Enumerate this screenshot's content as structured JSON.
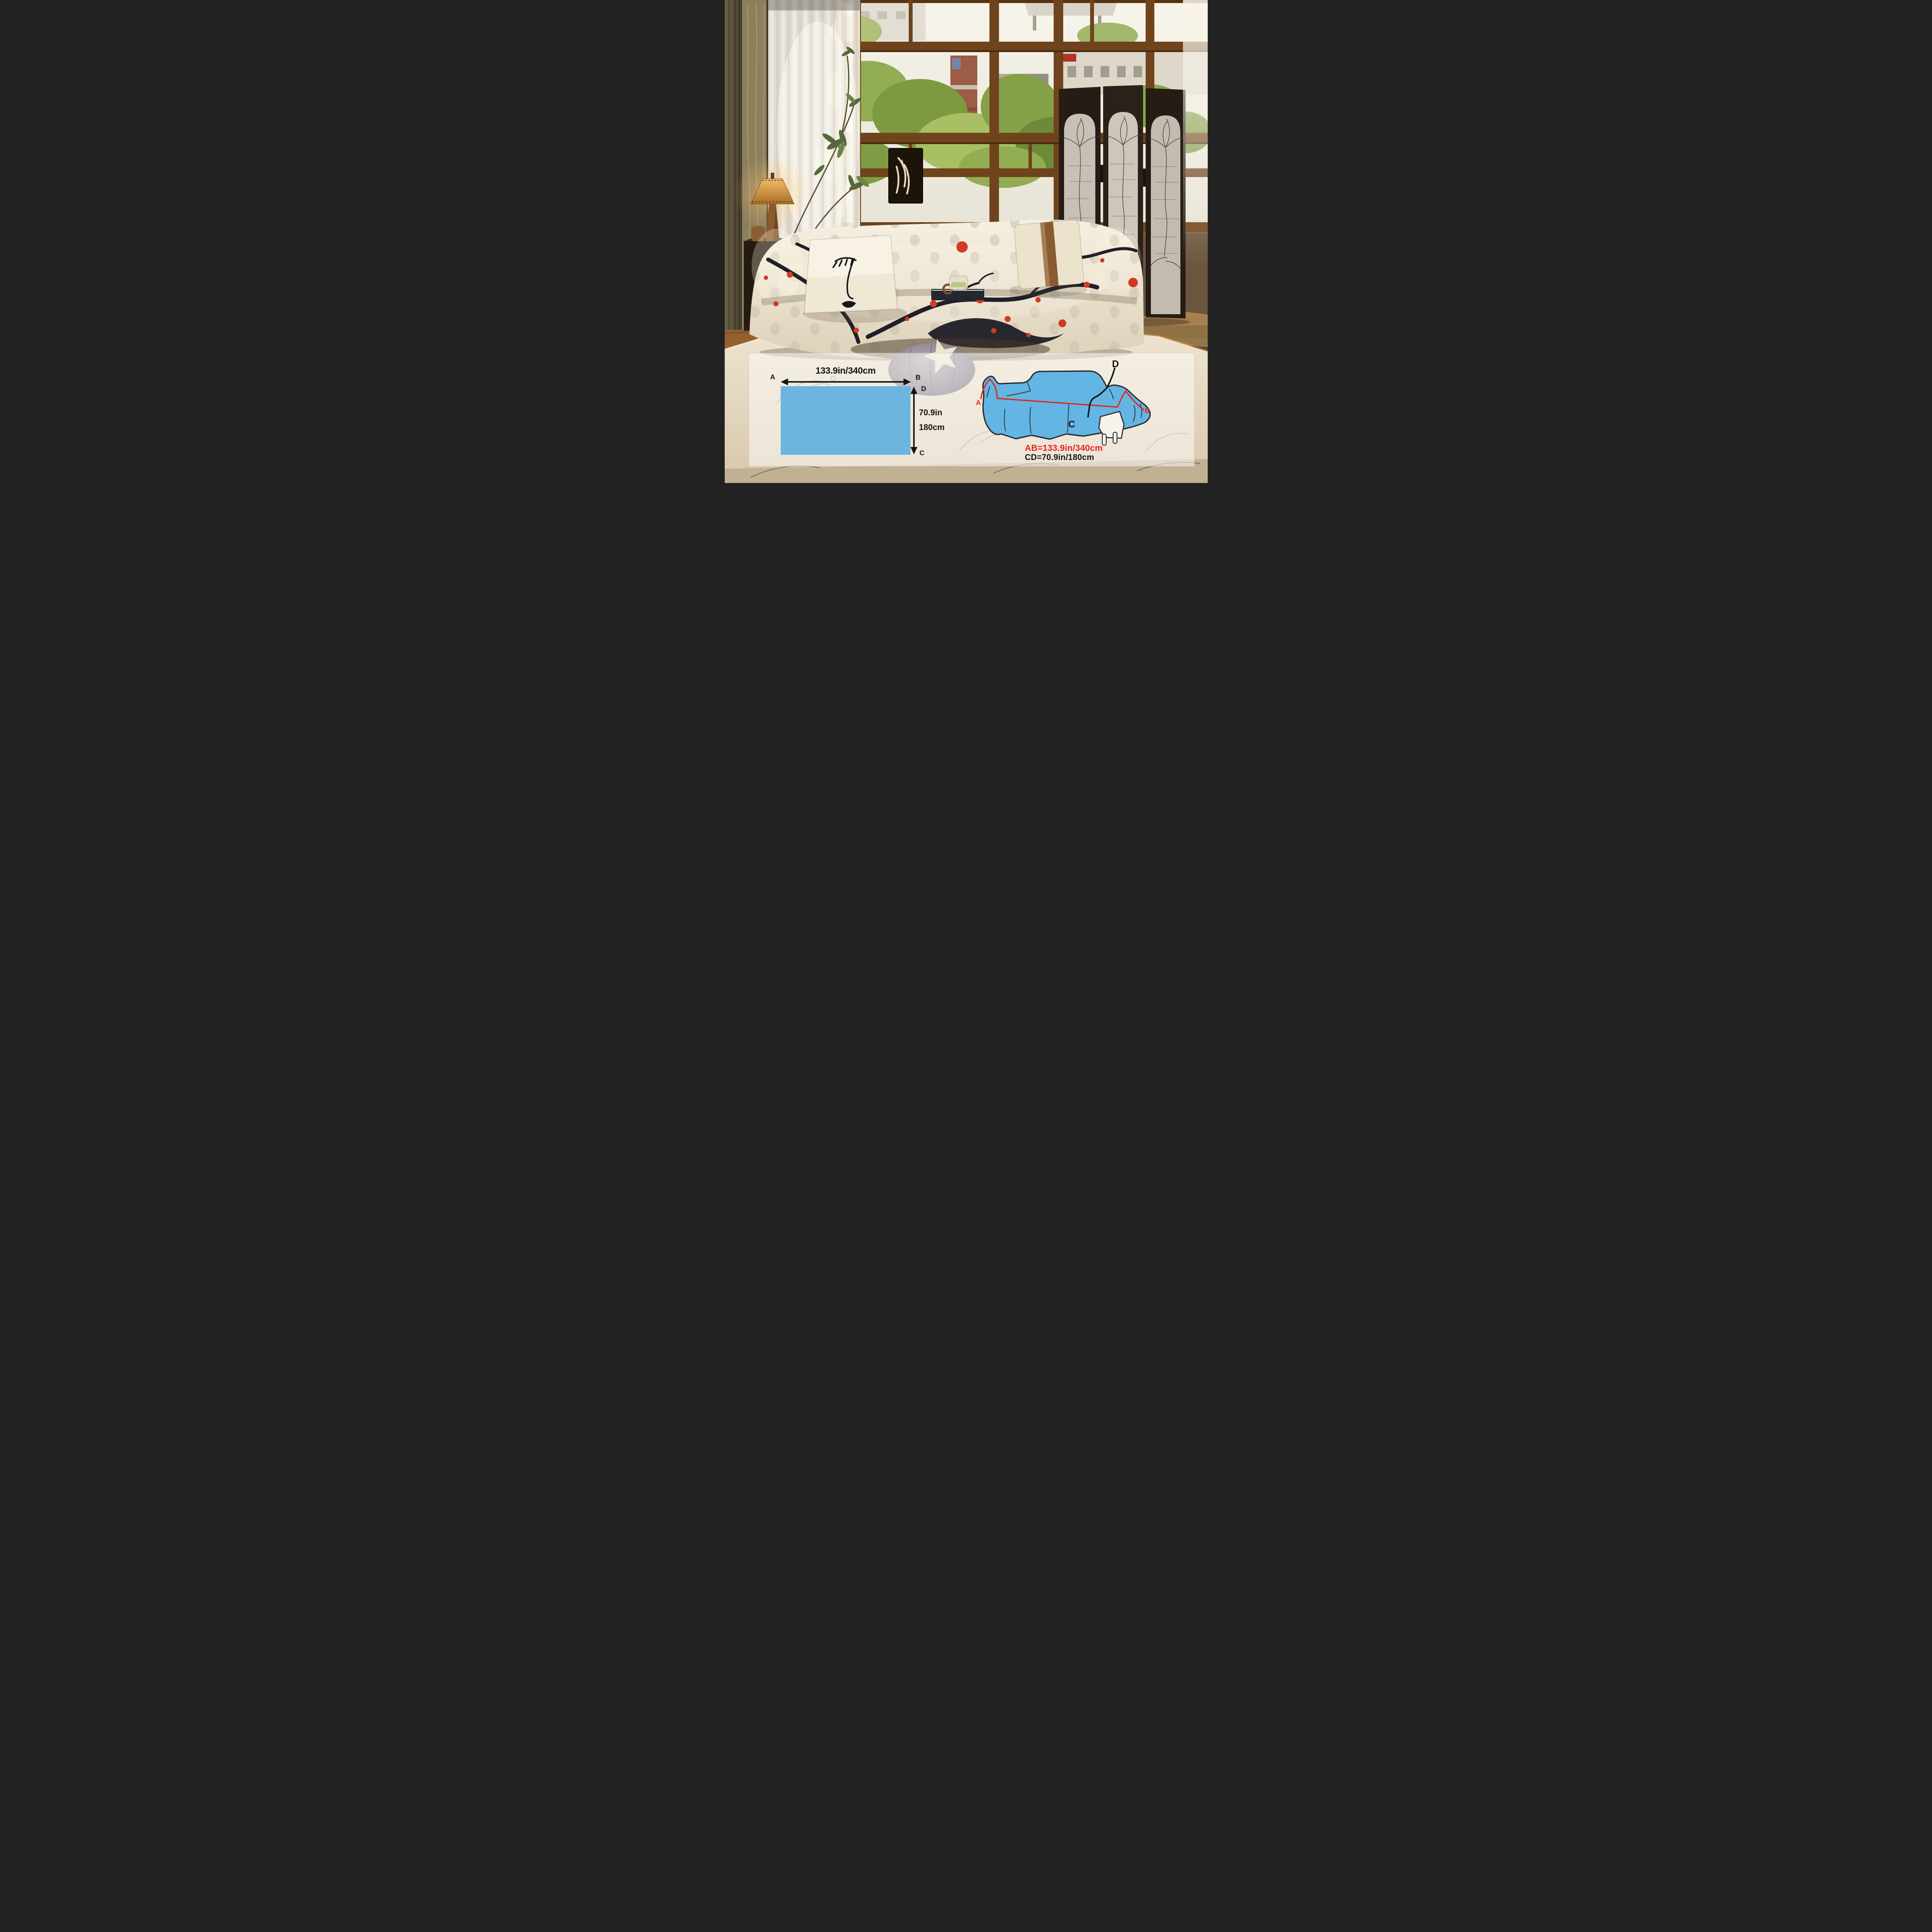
{
  "overlay": {
    "flat_sheet_diagram": {
      "corner_a": "A",
      "corner_b": "B",
      "corner_c": "C",
      "corner_d": "D",
      "width_label": "133.9in/340cm",
      "height_label_in": "70.9in",
      "height_label_cm": "180cm"
    },
    "sofa_diagram": {
      "point_a": "A",
      "point_b": "B",
      "point_c": "C",
      "point_d": "D",
      "ab_measure": "AB=133.9in/340cm",
      "cd_measure": "CD=70.9in/180cm"
    },
    "colors": {
      "sheet_fill": "#6CB5DE",
      "sofa_fill": "#63B6E3",
      "measure_red": "#E2261B",
      "measure_black": "#141414",
      "band_background": "rgba(252,250,246,0.55)"
    }
  }
}
